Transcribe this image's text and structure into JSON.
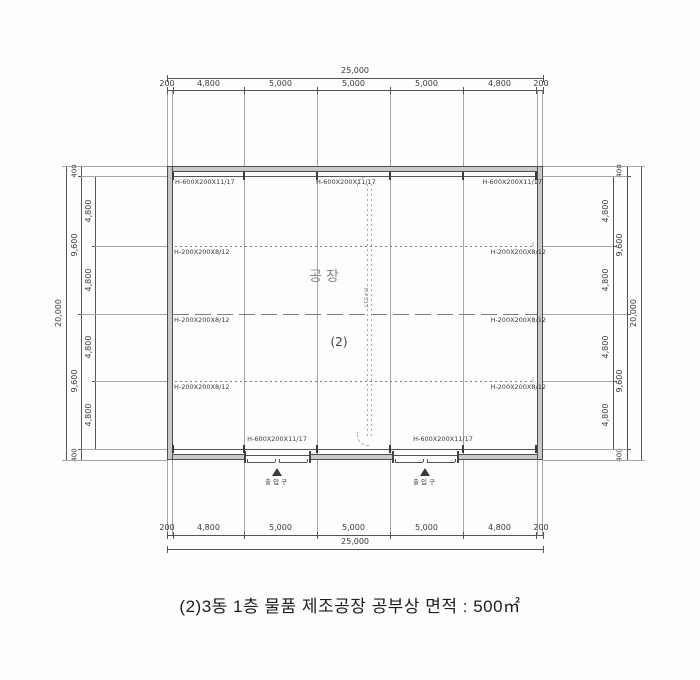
{
  "caption": "(2)3동 1층 물품 제조공장 공부상 면적 : 500㎡",
  "plan": {
    "room_label": "공장",
    "unit_number": "(2)",
    "trench_note": "H=517",
    "entrance_label": "출입구",
    "connector_open": "(",
    "connector_close": ")"
  },
  "beams": {
    "top_labels": [
      "H-600X200X11/17",
      "H-600X200X11/17",
      "H-600X200X11/17"
    ],
    "bottom_labels": [
      "H-600X200X11/17",
      "H-600X200X11/17"
    ],
    "girt_rows": [
      {
        "style": "dotted",
        "left": "H-200X200X8/12",
        "right": "H-200X200X8/12"
      },
      {
        "style": "dash",
        "left": "H-200X200X8/12",
        "right": "H-200X200X8/12"
      },
      {
        "style": "dotted",
        "left": "H-200X200X8/12",
        "right": "H-200X200X8/12"
      }
    ]
  },
  "dimensions": {
    "horizontal": {
      "overall": "25,000",
      "segments": [
        "200",
        "4,800",
        "5,000",
        "5,000",
        "5,000",
        "4,800",
        "200"
      ]
    },
    "vertical": {
      "overall": "20,000",
      "mid": [
        "400",
        "9,600",
        "9,600",
        "400"
      ],
      "inner": [
        "4,800",
        "4,800",
        "4,800",
        "4,800"
      ]
    }
  },
  "colors": {
    "paper": "#fdfdfd",
    "wall_fill": "#c9c9c9",
    "wall_edge": "#4f4f4f",
    "line_dark": "#555555",
    "line_mid": "#7d7d7d",
    "line_light": "#a6a6a6",
    "text": "#3a3a3a",
    "room_text": "#8a8a8a"
  }
}
